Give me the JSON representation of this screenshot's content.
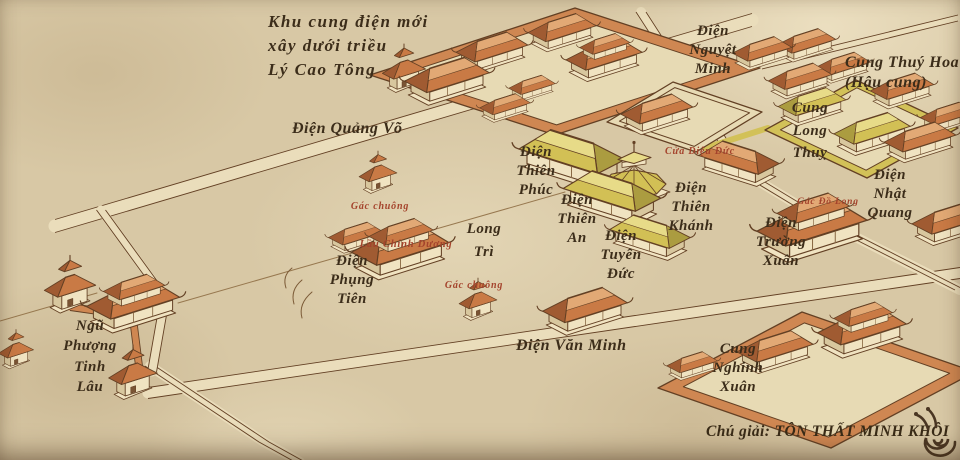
{
  "colors": {
    "paper": "#d8c8a5",
    "ink": "#3c2d1a",
    "red_ink": "#a4432c",
    "line": "#634024",
    "road": "#eaddbb",
    "court": "#e7dab4",
    "wall_orange": "#cf8752",
    "wall_yellow": "#d2c158",
    "roof_orange": "#c97a45",
    "roof_orange_light": "#e2a975",
    "roof_orange_dark": "#a05b32",
    "roof_yellow": "#d2c055",
    "roof_yellow_light": "#e7db88",
    "roof_yellow_dark": "#ab9c40",
    "building_wall": "#f0e3c1",
    "building_wall_shade": "#d8c79e"
  },
  "labels": [
    {
      "name": "khu-cung-dien-moi",
      "text": "Khu cung điện mới\nxây dưới triều\nLý Cao Tông"
    },
    {
      "name": "dien-quang-vo",
      "text": "Điện Quảng Võ"
    },
    {
      "name": "dien-nguyet-minh",
      "text": "Điện\nNguyệt\nMinh"
    },
    {
      "name": "cung-thuy-hoa",
      "text": "Cung Thuý Hoa\n(Hậu cung)"
    },
    {
      "name": "cung-long-thuy",
      "text": "Cung\nLong\nThuỵ"
    },
    {
      "name": "cua-dieu-duc",
      "text": "Cửa Diệu Đức"
    },
    {
      "name": "dien-thien-phuc",
      "text": "Điện\nThiên\nPhúc"
    },
    {
      "name": "dien-thien-an",
      "text": "Điện\nThiên\nAn"
    },
    {
      "name": "dien-tuyen-duc",
      "text": "Điện\nTuyên\nĐức"
    },
    {
      "name": "dien-thien-khanh",
      "text": "Điện\nThiên\nKhánh"
    },
    {
      "name": "long-tri",
      "text": "Long\nTrì"
    },
    {
      "name": "gac-chuong-1",
      "text": "Gác chuông"
    },
    {
      "name": "lau-chinh-duong",
      "text": "Lầu Chính Dương"
    },
    {
      "name": "dien-phung-tien",
      "text": "Điện\nPhụng\nTiên"
    },
    {
      "name": "gac-chuong-2",
      "text": "Gác chuông"
    },
    {
      "name": "dien-van-minh",
      "text": "Điện Văn Minh"
    },
    {
      "name": "ngu-phuong-tinh-lau",
      "text": "Ngũ\nPhượng\nTinh\nLâu"
    },
    {
      "name": "cung-nghinh-xuan",
      "text": "Cung\nNghinh\nXuân"
    },
    {
      "name": "dien-nhat-quang",
      "text": "Điện\nNhật\nQuang"
    },
    {
      "name": "gac-do-long",
      "text": "Gác Đồ Long"
    },
    {
      "name": "dien-truong-xuan",
      "text": "Điện\nTrường\nXuân"
    }
  ],
  "legend": {
    "credit": "Chú giải: TÔN THẤT MINH KHÔI",
    "logo_icon": "snail"
  }
}
